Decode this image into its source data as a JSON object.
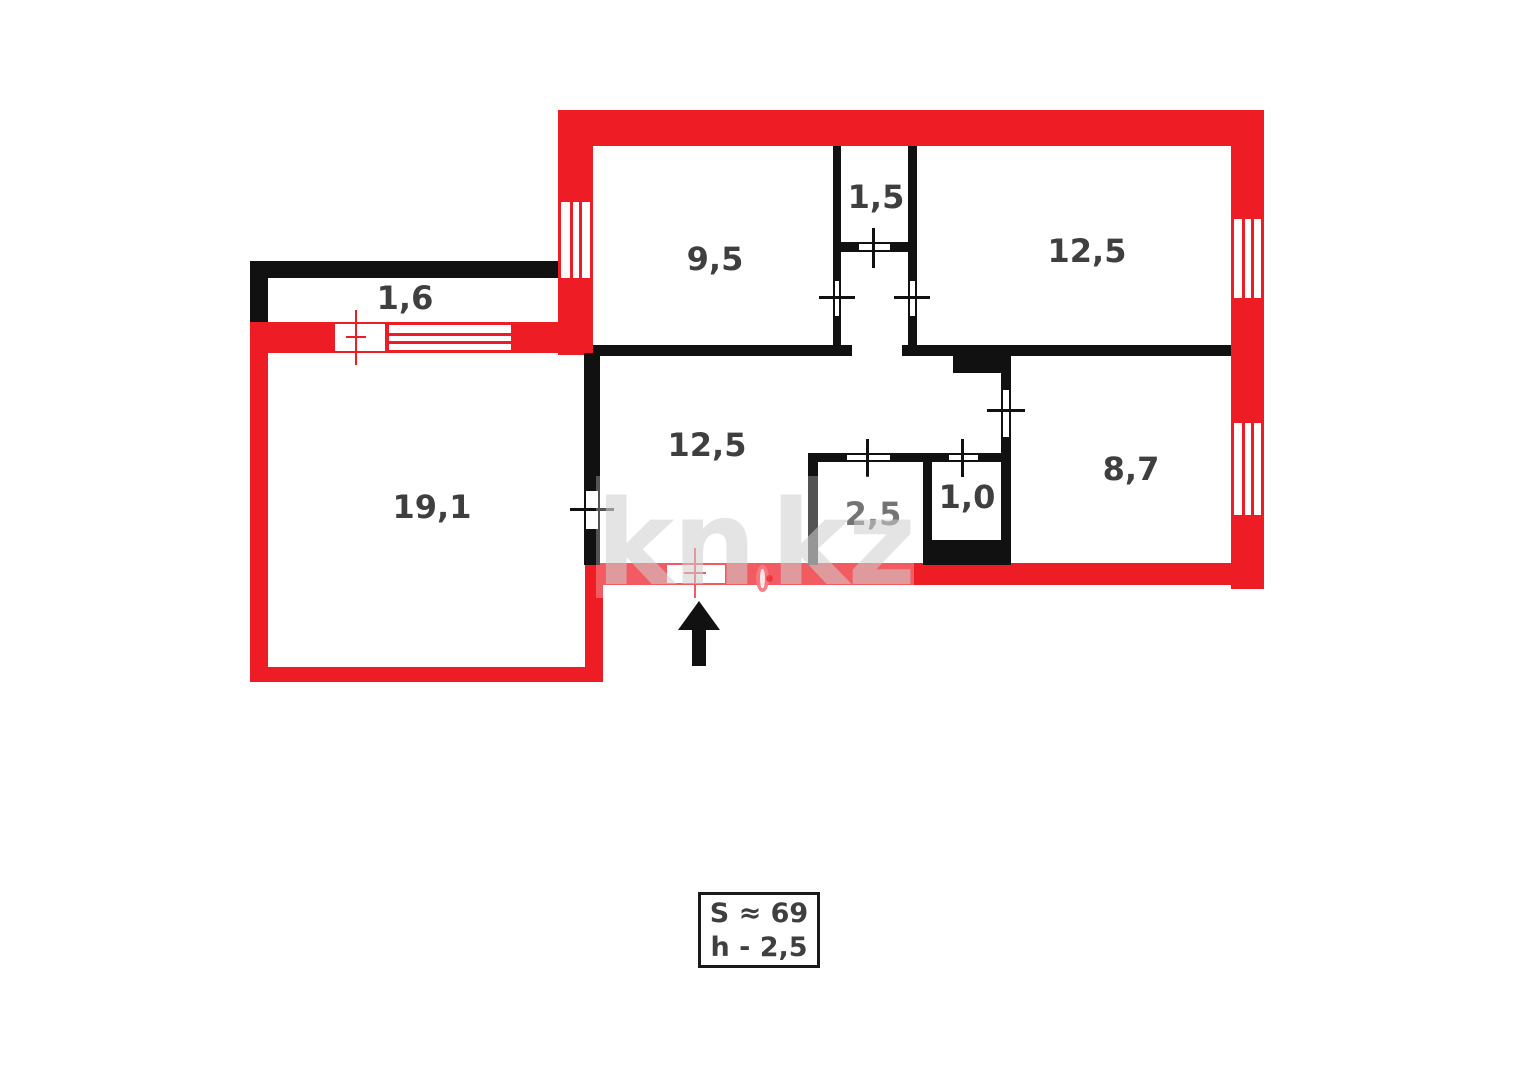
{
  "floorplan": {
    "rooms": [
      {
        "name": "balcony",
        "area": "1,6"
      },
      {
        "name": "room-top-left",
        "area": "9,5"
      },
      {
        "name": "closet",
        "area": "1,5"
      },
      {
        "name": "room-top-right",
        "area": "12,5"
      },
      {
        "name": "living-room",
        "area": "19,1"
      },
      {
        "name": "hall",
        "area": "12,5"
      },
      {
        "name": "bathroom",
        "area": "2,5"
      },
      {
        "name": "toilet",
        "area": "1,0"
      },
      {
        "name": "room-bottom-right",
        "area": "8,7"
      }
    ],
    "info_box": {
      "area_label": "S ≈ 69",
      "height_label": "h - 2,5"
    },
    "watermark": {
      "prefix": "kn",
      "suffix": "kz"
    },
    "colors": {
      "wall_red": "#ee1c25",
      "wall_black": "#111111",
      "label": "#3f3f3f"
    }
  }
}
